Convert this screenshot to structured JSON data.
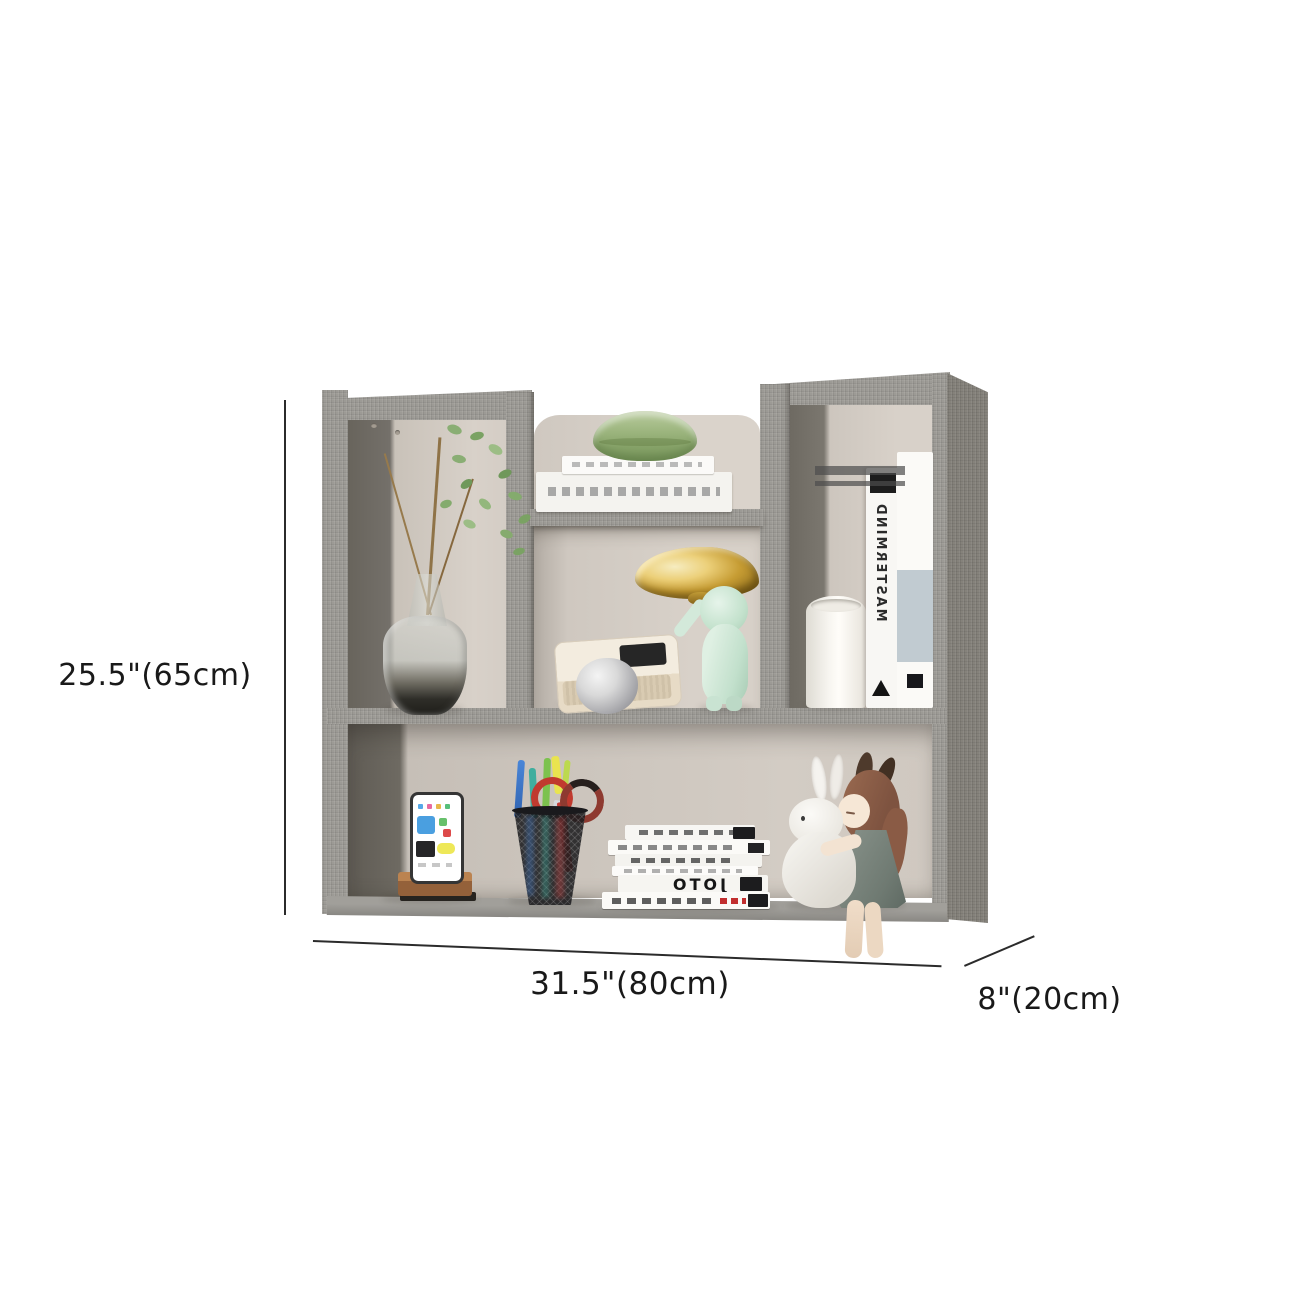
{
  "annotations": {
    "height_label": "25.5\"(65cm)",
    "width_label": "31.5\"(80cm)",
    "depth_label": "8\"(20cm)"
  },
  "product": {
    "type": "wall-mounted cube storage shelf",
    "finish": "grey linen",
    "colors": {
      "frame": "#9c9a95",
      "frame_shadow": "#6a665e",
      "side_panel": "#85827b",
      "interior_back": "#d6cfc7",
      "accent_gold": "#c69c33",
      "accent_mint": "#cfe7d8",
      "accent_green": "#9db67f"
    }
  },
  "decor_items": [
    {
      "name": "plant-in-glass-vase"
    },
    {
      "name": "flat-stacked-books"
    },
    {
      "name": "green-jar"
    },
    {
      "name": "gold-cloud-lamp"
    },
    {
      "name": "astronaut-figurine"
    },
    {
      "name": "retro-camera"
    },
    {
      "name": "paper-ball"
    },
    {
      "name": "pillar-candle"
    },
    {
      "name": "standing-books",
      "spine_text": "MASTERMIND"
    },
    {
      "name": "phone-on-wooden-stand"
    },
    {
      "name": "wire-pen-cup"
    },
    {
      "name": "scissors"
    },
    {
      "name": "book-stack",
      "spine_text": "JOTO"
    },
    {
      "name": "bunny-figurine"
    },
    {
      "name": "girl-doll"
    }
  ]
}
